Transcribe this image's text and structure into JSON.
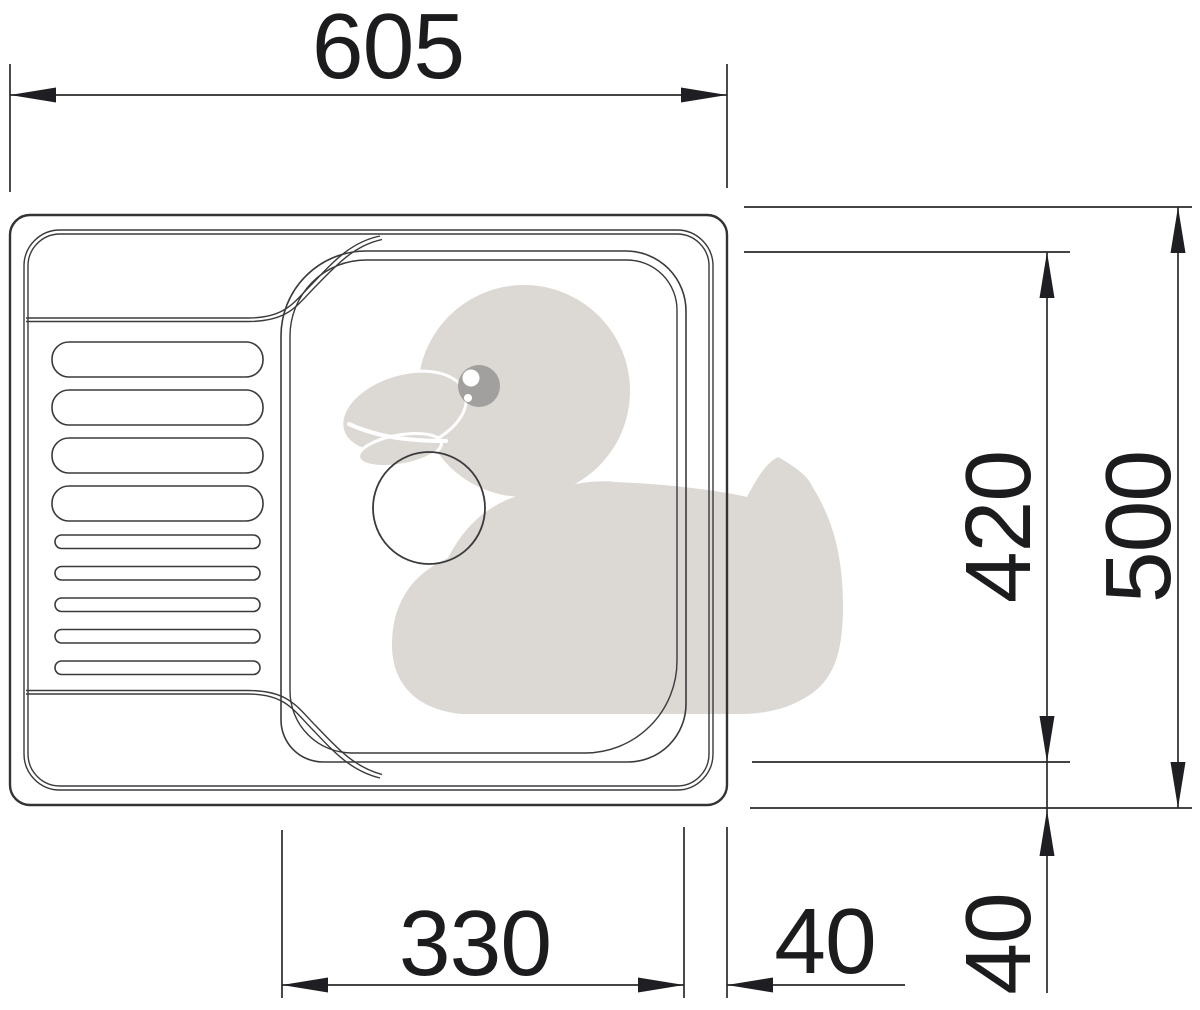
{
  "diagram": {
    "type": "technical-drawing",
    "subject": "kitchen-sink-top-view-with-drainboard",
    "watermark_icon": "rubber-duck-watermark",
    "dimensions": {
      "overall_width": "605",
      "overall_depth": "500",
      "bowl_height": "420",
      "bowl_width": "330",
      "bowl_to_edge_bottom": "40",
      "bowl_to_edge_right": "40"
    },
    "colors": {
      "background": "#ffffff",
      "line": "#3a3a3d",
      "dimension_text": "#1c1c1f",
      "duck_body": "#dcd8d4",
      "duck_eye": "#a2a09e",
      "duck_eye_highlight": "#ffffff"
    }
  }
}
